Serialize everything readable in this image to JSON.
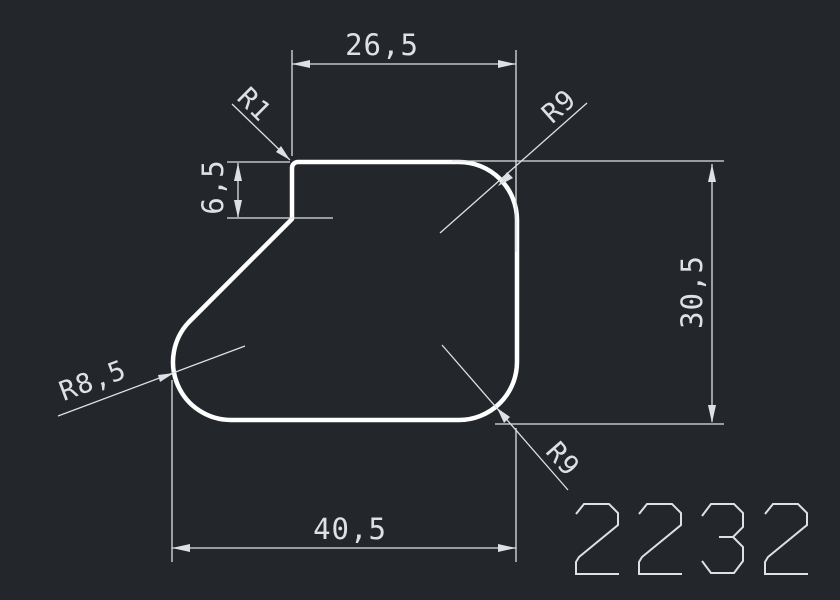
{
  "drawing": {
    "part_number": "2232",
    "colors": {
      "background": "#23272c",
      "profile": "#ffffff",
      "annotation": "#dde1e4"
    },
    "dimensions": {
      "top_width": "26,5",
      "left_step_height": "6,5",
      "right_height": "30,5",
      "bottom_width": "40,5"
    },
    "radii": {
      "top_left": "R1",
      "top_right": "R9",
      "bottom_right": "R9",
      "bottom_left": "R8,5"
    }
  }
}
